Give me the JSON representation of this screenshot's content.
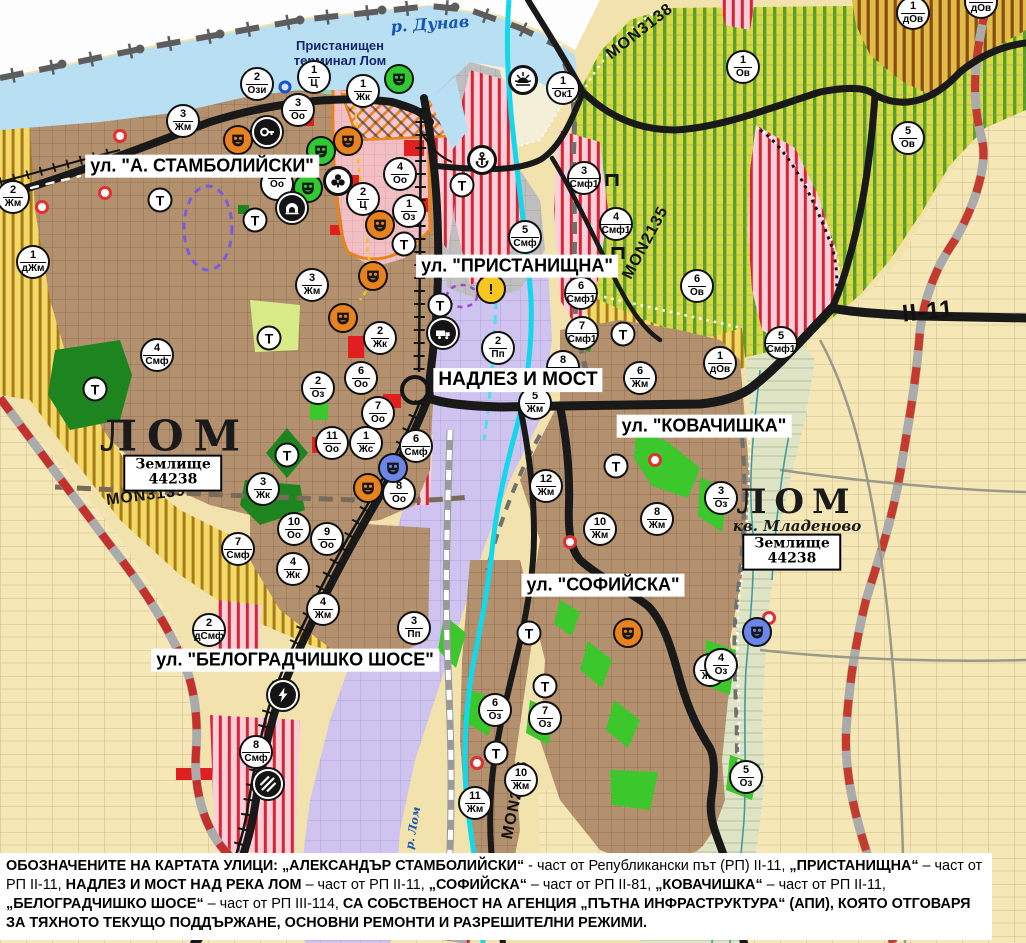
{
  "map": {
    "title_labels": {
      "river_danube": "р. Дунав",
      "river_lom": "р. Лом",
      "port_terminal_line1": "Пристанищен",
      "port_terminal_line2": "терминал Лом",
      "city_main": "ЛОМ",
      "city_quarter": "ЛОМ",
      "quarter_sub": "кв. Младеново",
      "land_unit_word": "Землище",
      "land_unit_code": "44238"
    },
    "street_labels": [
      {
        "text": "ул. \"А. СТАМБОЛИЙСКИ\""
      },
      {
        "text": "ул. \"ПРИСТАНИЩНА\""
      },
      {
        "text": "НАДЛЕЗ И МОСТ"
      },
      {
        "text": "ул. \"КОВАЧИШКА\""
      },
      {
        "text": "ул. \"СОФИЙСКА\""
      },
      {
        "text": "ул. \"БЕЛОГРАДЧИШКО ШОСЕ\""
      }
    ],
    "road_labels": [
      {
        "text": "MON3139"
      },
      {
        "text": "MON3138"
      },
      {
        "text": "MON2135"
      },
      {
        "text": "MON2136"
      },
      {
        "text": "II-11"
      }
    ],
    "badges": [
      {
        "n": "2",
        "c": "Ози",
        "x": 257,
        "y": 84
      },
      {
        "n": "1",
        "c": "Ц",
        "x": 314,
        "y": 77
      },
      {
        "n": "1",
        "c": "Жк",
        "x": 363,
        "y": 91
      },
      {
        "n": "3",
        "c": "Оо",
        "x": 298,
        "y": 110
      },
      {
        "n": "3",
        "c": "Жм",
        "x": 183,
        "y": 121
      },
      {
        "n": "4",
        "c": "Оо",
        "x": 400,
        "y": 174
      },
      {
        "n": "",
        "c": "Оо",
        "x": 277,
        "y": 184
      },
      {
        "n": "2",
        "c": "Ц",
        "x": 363,
        "y": 199
      },
      {
        "n": "1",
        "c": "Оз",
        "x": 409,
        "y": 211
      },
      {
        "n": "2",
        "c": "Жм",
        "x": 13,
        "y": 197
      },
      {
        "n": "1",
        "c": "дЖм",
        "x": 33,
        "y": 262
      },
      {
        "n": "3",
        "c": "Жм",
        "x": 312,
        "y": 285
      },
      {
        "n": "1",
        "c": "Ок1",
        "x": 563,
        "y": 88
      },
      {
        "n": "1",
        "c": "Ов",
        "x": 743,
        "y": 67
      },
      {
        "n": "1",
        "c": "дОв",
        "x": 913,
        "y": 13
      },
      {
        "n": "1",
        "c": "дОв",
        "x": 981,
        "y": 2
      },
      {
        "n": "5",
        "c": "Ов",
        "x": 908,
        "y": 138
      },
      {
        "n": "3",
        "c": "Смф1",
        "x": 584,
        "y": 178
      },
      {
        "n": "4",
        "c": "Смф1",
        "x": 616,
        "y": 224
      },
      {
        "n": "5",
        "c": "Смф",
        "x": 525,
        "y": 237
      },
      {
        "n": "6",
        "c": "Ов",
        "x": 697,
        "y": 286
      },
      {
        "n": "6",
        "c": "Смф1",
        "x": 581,
        "y": 293
      },
      {
        "n": "7",
        "c": "Смф1",
        "x": 582,
        "y": 333
      },
      {
        "n": "2",
        "c": "Пп",
        "x": 498,
        "y": 348
      },
      {
        "n": "8",
        "c": "Смф1",
        "x": 563,
        "y": 367
      },
      {
        "n": "5",
        "c": "Жм",
        "x": 535,
        "y": 403
      },
      {
        "n": "6",
        "c": "Жм",
        "x": 640,
        "y": 378
      },
      {
        "n": "1",
        "c": "дОв",
        "x": 720,
        "y": 363
      },
      {
        "n": "5",
        "c": "Смф1",
        "x": 781,
        "y": 343
      },
      {
        "n": "2",
        "c": "Жк",
        "x": 380,
        "y": 338
      },
      {
        "n": "6",
        "c": "Оо",
        "x": 361,
        "y": 378
      },
      {
        "n": "2",
        "c": "Оз",
        "x": 318,
        "y": 388
      },
      {
        "n": "7",
        "c": "Оо",
        "x": 378,
        "y": 413
      },
      {
        "n": "11",
        "c": "Оо",
        "x": 332,
        "y": 443
      },
      {
        "n": "1",
        "c": "Жс",
        "x": 366,
        "y": 443
      },
      {
        "n": "6",
        "c": "Смф",
        "x": 416,
        "y": 446
      },
      {
        "n": "8",
        "c": "Оо",
        "x": 399,
        "y": 493
      },
      {
        "n": "3",
        "c": "Жк",
        "x": 263,
        "y": 489
      },
      {
        "n": "4",
        "c": "Смф",
        "x": 157,
        "y": 355
      },
      {
        "n": "10",
        "c": "Оо",
        "x": 294,
        "y": 529
      },
      {
        "n": "9",
        "c": "Оо",
        "x": 327,
        "y": 539
      },
      {
        "n": "7",
        "c": "Смф",
        "x": 238,
        "y": 549
      },
      {
        "n": "4",
        "c": "Жк",
        "x": 293,
        "y": 569
      },
      {
        "n": "12",
        "c": "Жм",
        "x": 546,
        "y": 486
      },
      {
        "n": "3",
        "c": "Оз",
        "x": 721,
        "y": 498
      },
      {
        "n": "8",
        "c": "Жм",
        "x": 657,
        "y": 519
      },
      {
        "n": "10",
        "c": "Жм",
        "x": 600,
        "y": 529
      },
      {
        "n": "4",
        "c": "Жм",
        "x": 323,
        "y": 609
      },
      {
        "n": "3",
        "c": "Пп",
        "x": 414,
        "y": 628
      },
      {
        "n": "2",
        "c": "дСмф",
        "x": 209,
        "y": 630
      },
      {
        "n": "8",
        "c": "Смф",
        "x": 256,
        "y": 752
      },
      {
        "n": "6",
        "c": "Оз",
        "x": 495,
        "y": 710
      },
      {
        "n": "11",
        "c": "Жм",
        "x": 475,
        "y": 803
      },
      {
        "n": "10",
        "c": "Жм",
        "x": 521,
        "y": 780
      },
      {
        "n": "7",
        "c": "Оз",
        "x": 545,
        "y": 718
      },
      {
        "n": "9",
        "c": "Жм",
        "x": 710,
        "y": 670
      },
      {
        "n": "4",
        "c": "Оз",
        "x": 721,
        "y": 665
      },
      {
        "n": "5",
        "c": "Оз",
        "x": 746,
        "y": 777
      }
    ],
    "transport_stops": [
      {
        "x": 160,
        "y": 200
      },
      {
        "x": 255,
        "y": 220
      },
      {
        "x": 462,
        "y": 185
      },
      {
        "x": 404,
        "y": 244
      },
      {
        "x": 269,
        "y": 338
      },
      {
        "x": 95,
        "y": 389
      },
      {
        "x": 287,
        "y": 455
      },
      {
        "x": 440,
        "y": 305
      },
      {
        "x": 623,
        "y": 334
      },
      {
        "x": 616,
        "y": 466
      },
      {
        "x": 529,
        "y": 633
      },
      {
        "x": 545,
        "y": 686
      },
      {
        "x": 496,
        "y": 753
      }
    ],
    "transport_stop_letter": "Т",
    "icons": [
      {
        "t": "culture-o",
        "x": 238,
        "y": 140
      },
      {
        "t": "culture-o",
        "x": 348,
        "y": 141
      },
      {
        "t": "culture-o",
        "x": 380,
        "y": 225
      },
      {
        "t": "culture-o",
        "x": 373,
        "y": 276
      },
      {
        "t": "culture-o",
        "x": 343,
        "y": 318
      },
      {
        "t": "culture-o",
        "x": 368,
        "y": 488
      },
      {
        "t": "culture-o",
        "x": 628,
        "y": 633
      },
      {
        "t": "culture-g",
        "x": 399,
        "y": 79
      },
      {
        "t": "culture-g",
        "x": 321,
        "y": 151
      },
      {
        "t": "culture-g",
        "x": 308,
        "y": 188
      },
      {
        "t": "culture-b",
        "x": 393,
        "y": 468
      },
      {
        "t": "culture-b",
        "x": 757,
        "y": 632
      },
      {
        "t": "key",
        "x": 267,
        "y": 132
      },
      {
        "t": "club",
        "x": 338,
        "y": 181
      },
      {
        "t": "tunnel",
        "x": 292,
        "y": 208
      },
      {
        "t": "anchor",
        "x": 482,
        "y": 160
      },
      {
        "t": "sun",
        "x": 523,
        "y": 80
      },
      {
        "t": "warning",
        "x": 491,
        "y": 289
      },
      {
        "t": "truck",
        "x": 443,
        "y": 333
      },
      {
        "t": "lightning",
        "x": 283,
        "y": 695
      },
      {
        "t": "crossing",
        "x": 268,
        "y": 784
      },
      {
        "t": "gate",
        "x": 612,
        "y": 180
      },
      {
        "t": "gate",
        "x": 618,
        "y": 253
      }
    ],
    "red_rings": [
      {
        "x": 120,
        "y": 136
      },
      {
        "x": 105,
        "y": 193
      },
      {
        "x": 42,
        "y": 207
      },
      {
        "x": 655,
        "y": 460
      },
      {
        "x": 570,
        "y": 542
      },
      {
        "x": 477,
        "y": 763
      },
      {
        "x": 769,
        "y": 618
      }
    ],
    "blue_rings": [
      {
        "x": 285,
        "y": 87
      }
    ]
  },
  "footnote": {
    "segments": [
      {
        "bold": true,
        "text": "ОБОЗНАЧЕНИТЕ НА КАРТАТА УЛИЦИ: „АЛЕКСАНДЪР СТАМБОЛИЙСКИ“"
      },
      {
        "bold": false,
        "text": " - част от Републикански път (РП) II-11, "
      },
      {
        "bold": true,
        "text": "„ПРИСТАНИЩНА“"
      },
      {
        "bold": false,
        "text": " – част от РП II-11, "
      },
      {
        "bold": true,
        "text": "НАДЛЕЗ И МОСТ НАД РЕКА ЛОМ"
      },
      {
        "bold": false,
        "text": " – част от РП II-11, "
      },
      {
        "bold": true,
        "text": "„СОФИЙСКА“"
      },
      {
        "bold": false,
        "text": " – част от РП II-81, "
      },
      {
        "bold": true,
        "text": "„КОВАЧИШКА“"
      },
      {
        "bold": false,
        "text": " – част от РП II-11, "
      },
      {
        "bold": true,
        "text": "„БЕЛОГРАДЧИШКО ШОСЕ“"
      },
      {
        "bold": false,
        "text": " – част от РП III-114, "
      },
      {
        "bold": true,
        "text": "СА СОБСТВЕНОСТ НА АГЕНЦИЯ „ПЪТНА ИНФРАСТРУКТУРА“ (АПИ), КОЯТО ОТГОВАРЯ ЗА ТЯХНОТО ТЕКУЩО ПОДДЪРЖАНЕ, ОСНОВНИ РЕМОНТИ И РАЗРЕШИТЕЛНИ РЕЖИМИ."
      }
    ]
  }
}
